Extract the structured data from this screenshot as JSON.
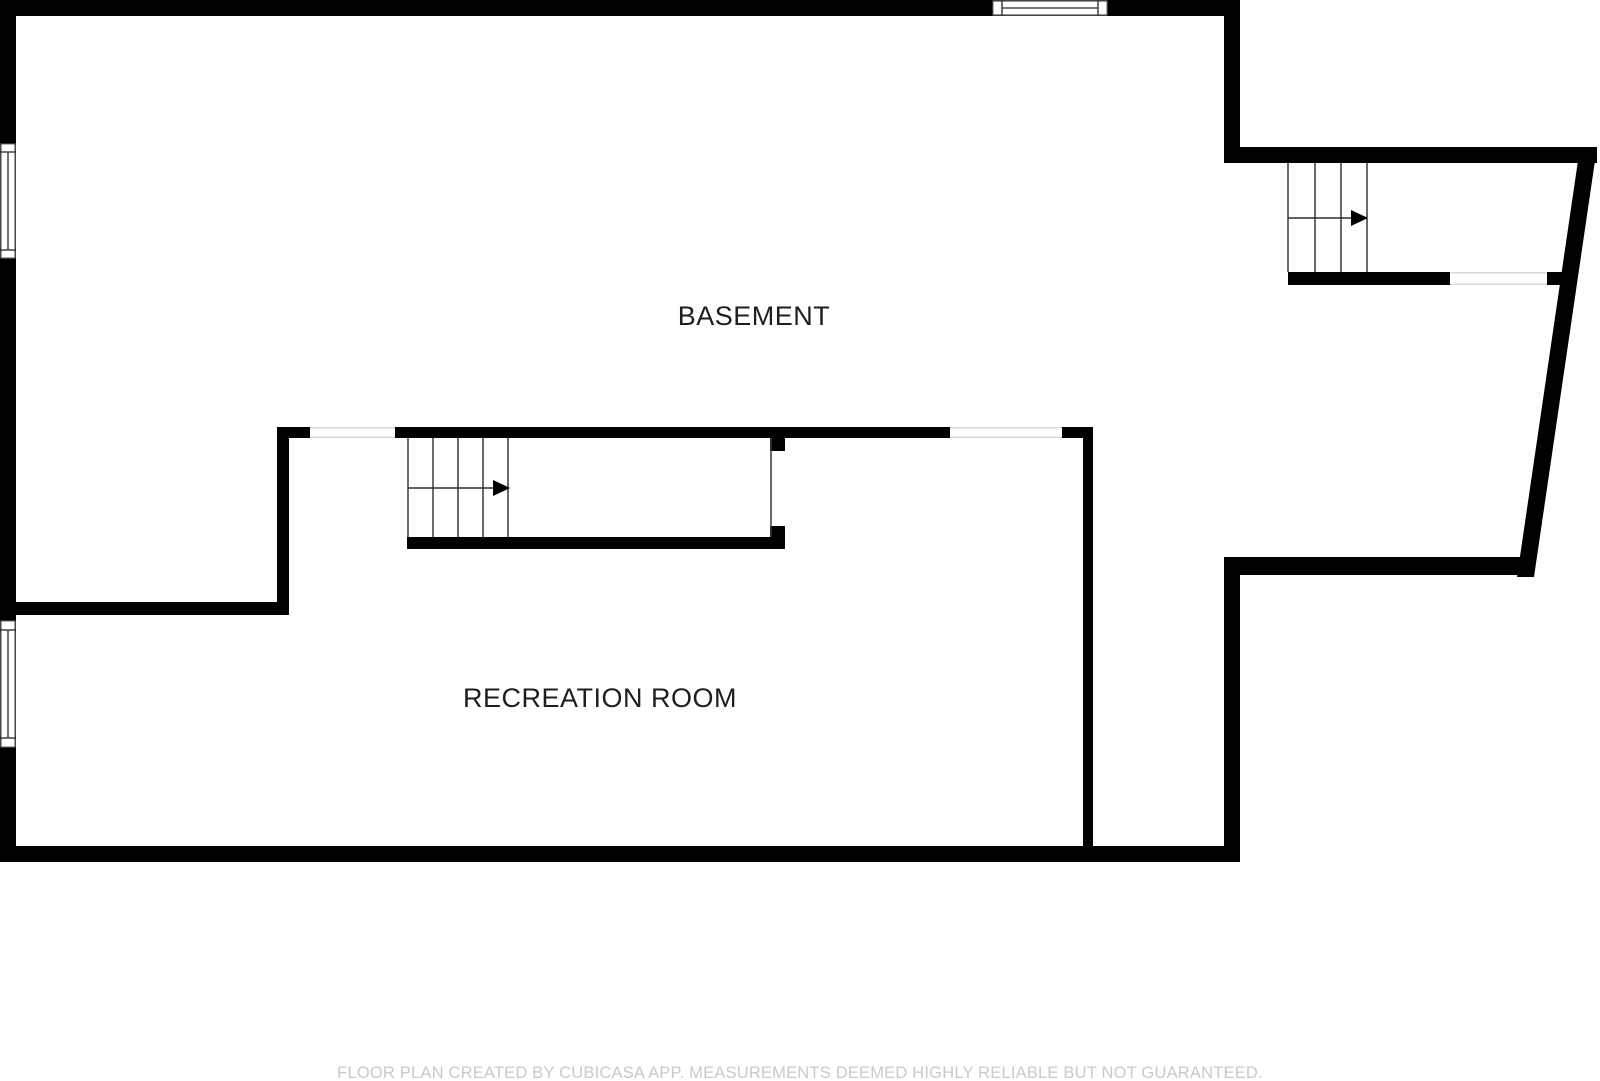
{
  "plan": {
    "title_note": "basement floor plan",
    "room_labels": [
      {
        "id": "basement",
        "text": "BASEMENT"
      },
      {
        "id": "recreation_room",
        "text": "RECREATION ROOM"
      }
    ],
    "stairs": [
      {
        "id": "main-stairs",
        "arrow_direction": "right"
      },
      {
        "id": "upper-wing-stairs",
        "arrow_direction": "right"
      }
    ],
    "colors": {
      "background": "#ffffff",
      "walls": "#000000",
      "stair_lines": "#3a3a3a",
      "opening_lines": "#d9d9d9",
      "room_label_text": "#1e1e1e",
      "footer_text": "#c9c9c9"
    }
  },
  "footer": {
    "disclaimer": "FLOOR PLAN CREATED BY CUBICASA APP. MEASUREMENTS DEEMED HIGHLY RELIABLE BUT NOT GUARANTEED."
  }
}
